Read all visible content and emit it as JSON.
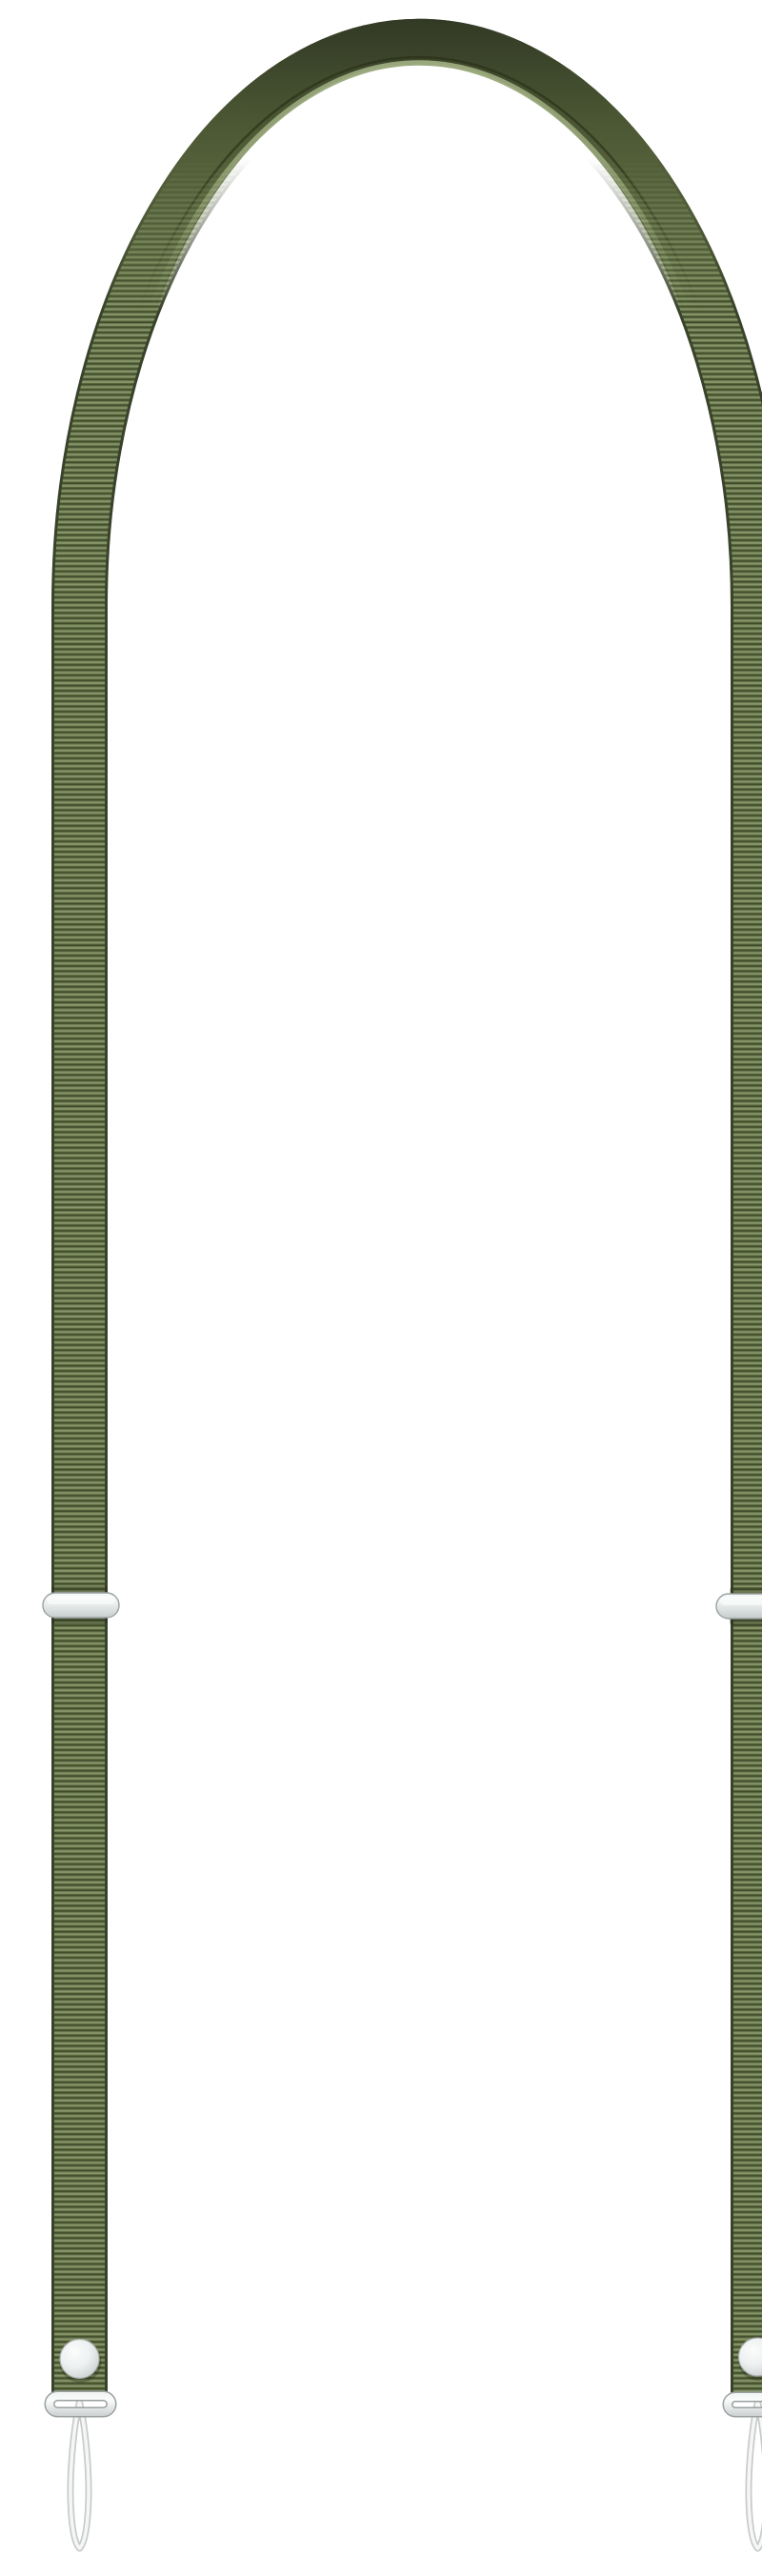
{
  "image": {
    "kind": "product-photo",
    "description": "Olive green ribbed nylon adjustable lanyard strap shaped as a tall inverted U on a plain white background, with two silver adjuster sliders, and at each strap end a round metal snap fastener, a silver strap-end bar and a thin white cord attachment loop hanging below"
  },
  "product": {
    "name": "Adjustable crossbody lanyard strap",
    "color_name": "olive green",
    "material": "ribbed nylon webbing"
  },
  "components": {
    "strap_webbing": "ribbed olive green webbing loop",
    "top_arc": "smooth shaded top arch of the strap",
    "left_slider": "silver length-adjuster slider (left strap)",
    "right_slider": "silver length-adjuster slider (right strap)",
    "left_snap": "round metal snap fastener (left strap end)",
    "right_snap": "round metal snap fastener (right strap end)",
    "left_end_bar": "silver strap-end bar (left)",
    "right_end_bar": "silver strap-end bar (right)",
    "left_cord_loop": "white cord attachment loop (left)",
    "right_cord_loop": "white cord attachment loop (right)"
  },
  "colors": {
    "background": "#ffffff",
    "strap_edge": "#39422a",
    "rib_dark": "#414c2b",
    "rib_mid": "#66764b",
    "rib_light": "#87966b",
    "rib_shade": "#5b693d",
    "arc_dark": "#313824",
    "arc_mid": "#4c5834",
    "arc_light": "#6f7e50",
    "arc_shade_line": "#2b3219",
    "arc_highlight": "#9aa87c",
    "metal_light": "#fbfcfc",
    "metal_mid": "#eef1f1",
    "metal_dark": "#c3c8c8",
    "metal_border": "#9aa0a0",
    "cord_edge": "#c6cbca",
    "cord_fill": "#f5f6f5",
    "shadow": "#1e2414"
  }
}
